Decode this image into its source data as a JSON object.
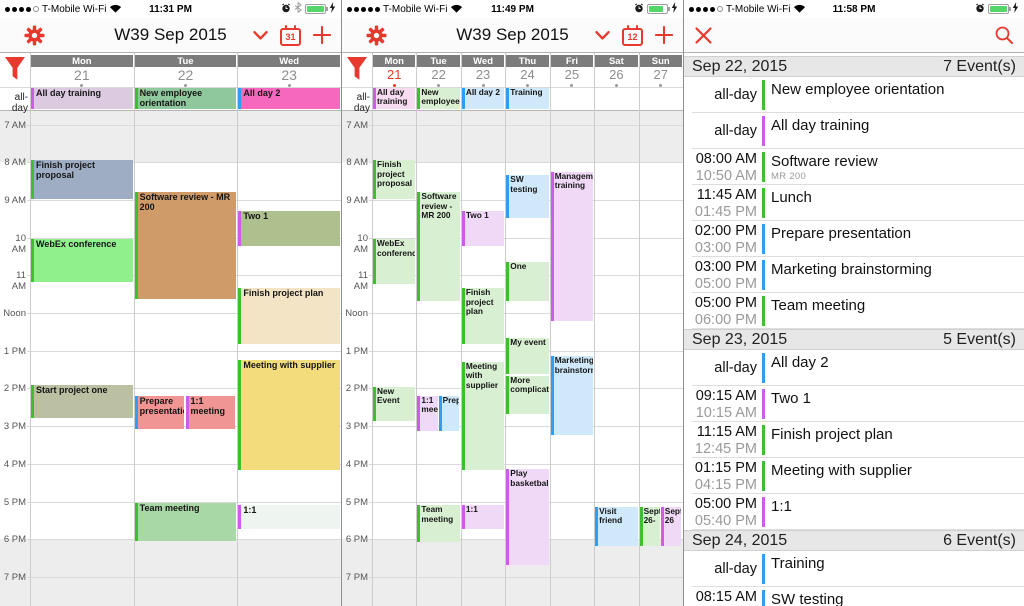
{
  "accent": "#e8392e",
  "calendar_colors": {
    "green": "#3fbf2f",
    "purple": "#cb5de8",
    "blue": "#2f9df2"
  },
  "hours": [
    "7 AM",
    "8 AM",
    "9 AM",
    "10 AM",
    "11 AM",
    "Noon",
    "1 PM",
    "2 PM",
    "3 PM",
    "4 PM",
    "5 PM",
    "6 PM",
    "7 PM"
  ],
  "panels": [
    {
      "name": "three-day-week",
      "status": {
        "carrier": "T-Mobile Wi-Fi",
        "time": "11:31 PM",
        "signal_filled": 4,
        "signal_total": 5,
        "bluetooth": true,
        "battery_level": 0.92
      },
      "nav": {
        "title": "W39 Sep 2015",
        "calendar_badge": "31",
        "left_icons": [
          "list-icon",
          "gear-icon"
        ],
        "right_icons": [
          "chevron-down-icon",
          "calendar-icon",
          "plus-icon"
        ]
      },
      "all_day_label": "all-day",
      "days": [
        {
          "name": "Mon",
          "num": "21",
          "today": false
        },
        {
          "name": "Tue",
          "num": "22",
          "today": false
        },
        {
          "name": "Wed",
          "num": "23",
          "today": false
        }
      ],
      "all_day_events": [
        {
          "day": 0,
          "title": "All day training",
          "bg": "#dccbe0",
          "border": "#cb5de8"
        },
        {
          "day": 1,
          "title": "New employee orientation",
          "bg": "#8fc89d",
          "border": "#3fbf2f"
        },
        {
          "day": 2,
          "title": "All day 2",
          "bg": "#f568bd",
          "border": "#2f9df2"
        }
      ],
      "events": [
        {
          "day": 0,
          "title": "Finish project proposal",
          "start": 7.95,
          "end": 9.0,
          "bg": "#9fadc4",
          "border": "#3fbf2f"
        },
        {
          "day": 0,
          "title": "WebEx conference",
          "start": 10.05,
          "end": 11.2,
          "bg": "#90f08c",
          "border": "#3fbf2f"
        },
        {
          "day": 0,
          "title": "Start project one",
          "start": 13.9,
          "end": 14.8,
          "bg": "#bcc0a3",
          "border": "#3fbf2f"
        },
        {
          "day": 1,
          "title": "Software review - MR 200",
          "start": 8.8,
          "end": 11.65,
          "bg": "#cf9c69",
          "border": "#3fbf2f"
        },
        {
          "day": 1,
          "title": "Prepare presentation",
          "start": 14.2,
          "end": 15.1,
          "bg": "#f09494",
          "border": "#2f9df2",
          "slot": 0,
          "slots": 2
        },
        {
          "day": 1,
          "title": "1:1 meeting",
          "start": 14.2,
          "end": 15.1,
          "bg": "#f09494",
          "border": "#cb5de8",
          "slot": 1,
          "slots": 2
        },
        {
          "day": 1,
          "title": "Team meeting",
          "start": 17.05,
          "end": 18.07,
          "bg": "#a8d8a6",
          "border": "#3fbf2f"
        },
        {
          "day": 2,
          "title": "Two 1",
          "start": 9.3,
          "end": 10.25,
          "bg": "#aec08e",
          "border": "#cb5de8"
        },
        {
          "day": 2,
          "title": "Finish project plan",
          "start": 11.35,
          "end": 12.85,
          "bg": "#f4e4c6",
          "border": "#3fbf2f"
        },
        {
          "day": 2,
          "title": "Meeting with supplier",
          "start": 13.25,
          "end": 16.2,
          "bg": "#f3dc7c",
          "border": "#3fbf2f"
        },
        {
          "day": 2,
          "title": "1:1",
          "start": 17.1,
          "end": 17.75,
          "bg": "#eef4ef",
          "border": "#cb5de8"
        }
      ]
    },
    {
      "name": "seven-day-week",
      "status": {
        "carrier": "T-Mobile Wi-Fi",
        "time": "11:49 PM",
        "signal_filled": 5,
        "signal_total": 5,
        "bluetooth": false,
        "battery_level": 0.72
      },
      "nav": {
        "title": "W39 Sep 2015",
        "calendar_badge": "12",
        "left_icons": [
          "list-icon",
          "gear-icon"
        ],
        "right_icons": [
          "chevron-down-icon",
          "calendar-icon",
          "plus-icon"
        ]
      },
      "all_day_label": "all-day",
      "days": [
        {
          "name": "Mon",
          "num": "21",
          "today": true
        },
        {
          "name": "Tue",
          "num": "22",
          "today": false
        },
        {
          "name": "Wed",
          "num": "23",
          "today": false
        },
        {
          "name": "Thu",
          "num": "24",
          "today": false
        },
        {
          "name": "Fri",
          "num": "25",
          "today": false
        },
        {
          "name": "Sat",
          "num": "26",
          "today": false
        },
        {
          "name": "Sun",
          "num": "27",
          "today": false
        }
      ],
      "all_day_events": [
        {
          "day": 0,
          "title": "All day training",
          "bg": "#f7dbf0",
          "border": "#cb5de8"
        },
        {
          "day": 1,
          "title": "New employee",
          "bg": "#d8efd2",
          "border": "#3fbf2f"
        },
        {
          "day": 2,
          "title": "All day 2",
          "bg": "#cfe8fa",
          "border": "#2f9df2"
        },
        {
          "day": 3,
          "title": "Training",
          "bg": "#cfe8fa",
          "border": "#2f9df2"
        }
      ],
      "events": [
        {
          "day": 0,
          "title": "Finish project proposal",
          "start": 7.95,
          "end": 9.0,
          "bg": "#d8efd2",
          "border": "#3fbf2f"
        },
        {
          "day": 0,
          "title": "WebEx conference",
          "start": 10.05,
          "end": 11.25,
          "bg": "#d8efd2",
          "border": "#3fbf2f"
        },
        {
          "day": 0,
          "title": "New Event",
          "start": 13.95,
          "end": 14.9,
          "bg": "#d8efd2",
          "border": "#3fbf2f"
        },
        {
          "day": 1,
          "title": "Software review - MR 200",
          "start": 8.8,
          "end": 11.7,
          "bg": "#d8efd2",
          "border": "#3fbf2f"
        },
        {
          "day": 1,
          "title": "1:1 meeting",
          "start": 14.2,
          "end": 15.15,
          "bg": "#f0d9f7",
          "border": "#cb5de8",
          "slot": 0,
          "slots": 2
        },
        {
          "day": 1,
          "title": "Prepare",
          "start": 14.2,
          "end": 15.15,
          "bg": "#cfe8fa",
          "border": "#2f9df2",
          "slot": 1,
          "slots": 2
        },
        {
          "day": 1,
          "title": "Team meeting",
          "start": 17.1,
          "end": 18.1,
          "bg": "#d8efd2",
          "border": "#3fbf2f"
        },
        {
          "day": 2,
          "title": "Two 1",
          "start": 9.3,
          "end": 10.25,
          "bg": "#f0d9f7",
          "border": "#cb5de8"
        },
        {
          "day": 2,
          "title": "Finish project plan",
          "start": 11.35,
          "end": 12.85,
          "bg": "#d8efd2",
          "border": "#3fbf2f"
        },
        {
          "day": 2,
          "title": "Meeting with supplier",
          "start": 13.3,
          "end": 16.2,
          "bg": "#d8efd2",
          "border": "#3fbf2f"
        },
        {
          "day": 2,
          "title": "1:1",
          "start": 17.1,
          "end": 17.75,
          "bg": "#f0d9f7",
          "border": "#cb5de8"
        },
        {
          "day": 3,
          "title": "SW testing",
          "start": 8.35,
          "end": 9.5,
          "bg": "#cfe8fa",
          "border": "#2f9df2"
        },
        {
          "day": 3,
          "title": "One",
          "start": 10.65,
          "end": 11.7,
          "bg": "#d8efd2",
          "border": "#3fbf2f"
        },
        {
          "day": 3,
          "title": "My event",
          "start": 12.65,
          "end": 13.65,
          "bg": "#d8efd2",
          "border": "#3fbf2f"
        },
        {
          "day": 3,
          "title": "More complication",
          "start": 13.67,
          "end": 14.7,
          "bg": "#d8efd2",
          "border": "#3fbf2f"
        },
        {
          "day": 3,
          "title": "Play basketball",
          "start": 16.15,
          "end": 18.7,
          "bg": "#f0d9f7",
          "border": "#cb5de8"
        },
        {
          "day": 4,
          "title": "Management training",
          "start": 8.25,
          "end": 12.25,
          "bg": "#f0d9f7",
          "border": "#cb5de8"
        },
        {
          "day": 4,
          "title": "Marketing brainstorming",
          "start": 13.15,
          "end": 15.25,
          "bg": "#cfe8fa",
          "border": "#2f9df2"
        },
        {
          "day": 5,
          "title": "Visit friend",
          "start": 17.15,
          "end": 18.2,
          "bg": "#cfe8fa",
          "border": "#2f9df2"
        },
        {
          "day": 6,
          "title": "Sept. 26-",
          "start": 17.15,
          "end": 18.2,
          "bg": "#d8efd2",
          "border": "#3fbf2f",
          "slot": 0,
          "slots": 2
        },
        {
          "day": 6,
          "title": "Sept 26",
          "start": 17.15,
          "end": 18.2,
          "bg": "#f0d9f7",
          "border": "#cb5de8",
          "slot": 1,
          "slots": 2
        }
      ]
    },
    {
      "name": "event-list",
      "status": {
        "carrier": "T-Mobile Wi-Fi",
        "time": "11:58 PM",
        "signal_filled": 4,
        "signal_total": 5,
        "bluetooth": false,
        "battery_level": 0.88
      },
      "nav": {
        "title": "",
        "left_icons": [
          "close-icon"
        ],
        "right_icons": [
          "search-icon"
        ]
      },
      "sections": [
        {
          "date": "Sep 22, 2015",
          "count": "7 Event(s)",
          "rows": [
            {
              "start": "all-day",
              "end": "",
              "bar": "green",
              "title": "New employee orientation",
              "sub": ""
            },
            {
              "start": "all-day",
              "end": "",
              "bar": "purple",
              "title": "All day training",
              "sub": ""
            },
            {
              "start": "08:00 AM",
              "end": "10:50 AM",
              "bar": "green",
              "title": "Software review",
              "sub": "MR 200"
            },
            {
              "start": "11:45 AM",
              "end": "01:45 PM",
              "bar": "green",
              "title": "Lunch",
              "sub": ""
            },
            {
              "start": "02:00 PM",
              "end": "03:00 PM",
              "bar": "blue",
              "title": "Prepare presentation",
              "sub": ""
            },
            {
              "start": "03:00 PM",
              "end": "05:00 PM",
              "bar": "blue",
              "title": "Marketing brainstorming",
              "sub": ""
            },
            {
              "start": "05:00 PM",
              "end": "06:00 PM",
              "bar": "green",
              "title": "Team meeting",
              "sub": ""
            }
          ]
        },
        {
          "date": "Sep 23, 2015",
          "count": "5 Event(s)",
          "rows": [
            {
              "start": "all-day",
              "end": "",
              "bar": "blue",
              "title": "All day 2",
              "sub": ""
            },
            {
              "start": "09:15 AM",
              "end": "10:15 AM",
              "bar": "purple",
              "title": "Two 1",
              "sub": ""
            },
            {
              "start": "11:15 AM",
              "end": "12:45 PM",
              "bar": "green",
              "title": "Finish project plan",
              "sub": ""
            },
            {
              "start": "01:15 PM",
              "end": "04:15 PM",
              "bar": "green",
              "title": "Meeting with supplier",
              "sub": ""
            },
            {
              "start": "05:00 PM",
              "end": "05:40 PM",
              "bar": "purple",
              "title": "1:1",
              "sub": ""
            }
          ]
        },
        {
          "date": "Sep 24, 2015",
          "count": "6 Event(s)",
          "rows": [
            {
              "start": "all-day",
              "end": "",
              "bar": "blue",
              "title": "Training",
              "sub": ""
            },
            {
              "start": "08:15 AM",
              "end": "",
              "bar": "blue",
              "title": "SW testing",
              "sub": ""
            }
          ]
        }
      ]
    }
  ]
}
